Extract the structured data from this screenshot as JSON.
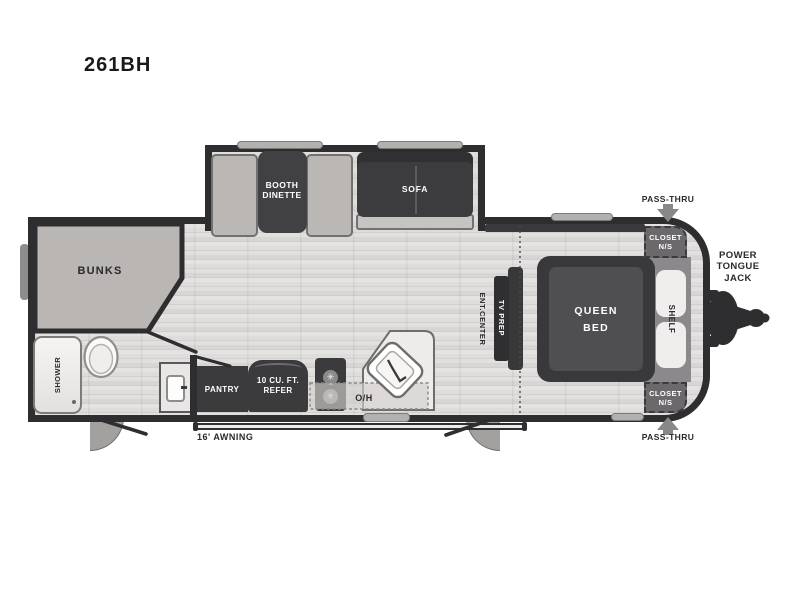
{
  "title": "261BH",
  "colors": {
    "wall": "#2e2d2f",
    "dark_furniture": "#3b3a3d",
    "light_furniture": "#bab7b4",
    "floor": "#e0dfdd",
    "mid_gray_band": "#8b898b",
    "arrow_gray": "#8a8886",
    "fixture_white": "#f5f4f2"
  },
  "slide_out": {
    "booth_dinette_line1": "BOOTH",
    "booth_dinette_line2": "DINETTE",
    "sofa": "SOFA"
  },
  "bunkroom": {
    "bunks": "BUNKS"
  },
  "bathroom": {
    "shower": "SHOWER"
  },
  "kitchen": {
    "pantry": "PANTRY",
    "refer_line1": "10 CU. FT.",
    "refer_line2": "REFER",
    "overhead": "O/H"
  },
  "living": {
    "ent_center": "ENT.CENTER",
    "tv_prep": "TV PREP"
  },
  "bedroom": {
    "queen_line1": "QUEEN",
    "queen_line2": "BED",
    "shelf": "SHELF",
    "closet_top_line1": "CLOSET",
    "closet_top_line2": "N/S",
    "closet_bottom_line1": "CLOSET",
    "closet_bottom_line2": "N/S"
  },
  "exterior": {
    "pass_thru_top": "PASS-THRU",
    "pass_thru_bottom": "PASS-THRU",
    "jack_line1": "POWER",
    "jack_line2": "TONGUE",
    "jack_line3": "JACK",
    "awning": "16' AWNING"
  }
}
